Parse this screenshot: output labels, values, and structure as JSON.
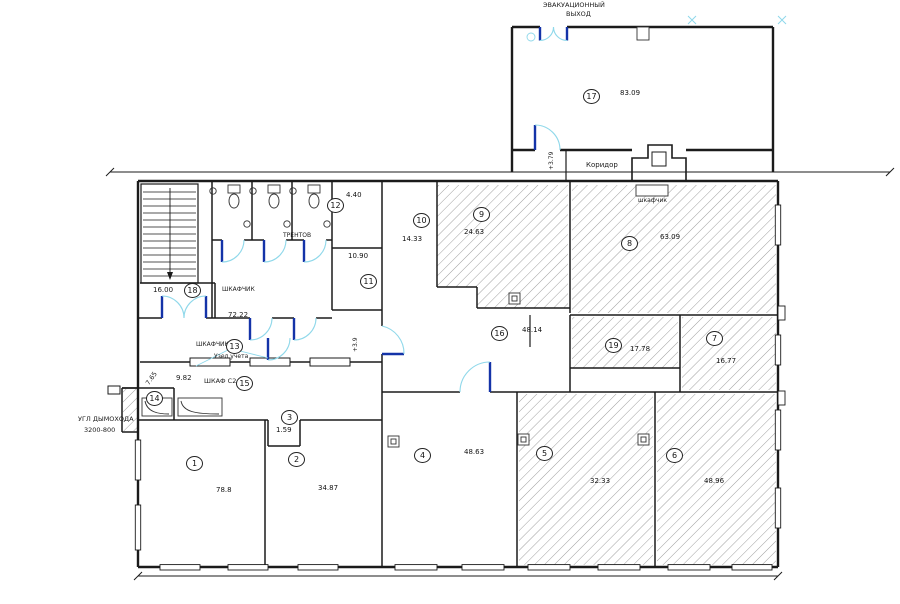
{
  "plan": {
    "title": "floor-plan",
    "colors": {
      "wall": "#1b1b1b",
      "hatch": "#777777",
      "door_arc": "#8fd8ea",
      "door_leaf": "#1433a8",
      "text": "#1a1a1a"
    }
  },
  "annotations": {
    "evac_line1": "ЭВАКУАЦИОННЫЙ",
    "evac_line2": "ВЫХОД",
    "corridor": "Коридор",
    "elev_upper": "+3.79",
    "elev_inner": "+3.9",
    "closet_top": "шкафчик",
    "closet_left": "ШКАФЧИК",
    "closet_mid": "ШКАФЧИК",
    "meter_unit": "Узел учета",
    "wardrobe": "ШКАФ С2",
    "trainer": "ТРЕНТОВ",
    "corner_line1": "УГЛ ДЫМОХОДА",
    "corner_line2": "3200-800",
    "hall_area": "72.22",
    "stair_room_area": "16.00",
    "shaft_area": "7.65",
    "wardrobe_area": "9.82"
  },
  "rooms": {
    "r1": {
      "num": "1",
      "area": "78.8"
    },
    "r2": {
      "num": "2",
      "area": "34.87"
    },
    "r3": {
      "num": "3",
      "area": "1.59"
    },
    "r4": {
      "num": "4",
      "area": "48.63"
    },
    "r5": {
      "num": "5",
      "area": "32.33"
    },
    "r6": {
      "num": "6",
      "area": "48.96"
    },
    "r7": {
      "num": "7",
      "area": "16.77"
    },
    "r8": {
      "num": "8",
      "area": "63.09"
    },
    "r9": {
      "num": "9",
      "area": "24.63"
    },
    "r10": {
      "num": "10",
      "area": "14.33"
    },
    "r11": {
      "num": "11",
      "area": "10.90"
    },
    "r12": {
      "num": "12",
      "area": "4.40"
    },
    "r13": {
      "num": "13",
      "area": ""
    },
    "r14": {
      "num": "14",
      "area": "7.65"
    },
    "r15": {
      "num": "15",
      "area": "9.82"
    },
    "r16": {
      "num": "16",
      "area": "48.14"
    },
    "r17": {
      "num": "17",
      "area": "83.09"
    },
    "r18": {
      "num": "18",
      "area": "16.00"
    },
    "r19": {
      "num": "19",
      "area": "17.78"
    }
  }
}
